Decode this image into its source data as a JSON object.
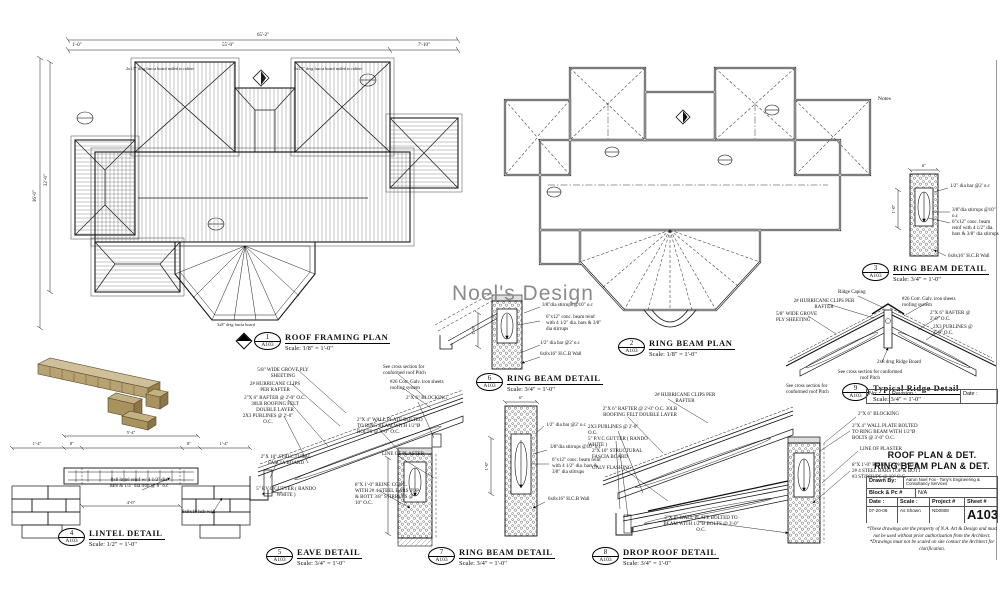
{
  "sheet": {
    "watermark": "Noel's Design",
    "notes_label": "Notes"
  },
  "plan1": {
    "num": "1",
    "ref": "A103",
    "title": "ROOF FRAMING PLAN",
    "scale": "Scale: 1/8\" = 1'-0\"",
    "dim_overall": "65'-2\"",
    "dim_main": "55'-0\"",
    "dim_right": "7'-10\"",
    "dim_end": "1'-0\"",
    "dim_v_overall": "36'-0\"",
    "dim_v_main": "32'-0\"",
    "note_fascia": "2x1.5\" drsg fascia board nailed to rafters",
    "note_bottom": "3x8\" drsg fascia board"
  },
  "plan2": {
    "num": "2",
    "ref": "A103",
    "title": "RING BEAM PLAN",
    "scale": "Scale: 1/8\" = 1'-0\""
  },
  "d3": {
    "num": "3",
    "ref": "A103",
    "title": "RING BEAM DETAIL",
    "scale": "Scale: 3/4\" = 1'-0\"",
    "bar": "1/2\" dia bar @2' o.c",
    "stirrups": "3/8\"dia stirrups @10\" o.c",
    "beam": "6\"x12\" conc. beam reinf with 4 1/2\" dia. bars & 3/8\" dia stirrups",
    "wall": "6x8x16\" H.C.B Wall",
    "dim_w": "6\"",
    "dim_h": "1'-0\""
  },
  "d4": {
    "num": "4",
    "ref": "A103",
    "title": "LINTEL DETAIL",
    "scale": "Scale: 1/2\" = 1'-0\"",
    "reinf": "8x8 lintel reinf w/ 4 1/2\" dia bars & 1/4\" dia iron @ 6\" o.c",
    "wall": "8x8x18 hcb wall",
    "dim_top": "5'-4\"",
    "dim_l": "1'-4\"",
    "dim_l8": "8\"",
    "dim_r8": "8\"",
    "dim_r": "1'-4\"",
    "dim_span": "4'-0\""
  },
  "d5": {
    "num": "5",
    "ref": "A103",
    "title": "EAVE DETAIL",
    "scale": "Scale: 3/4\" = 1'-0\"",
    "ply": "5/8\" WIDE GROVE PLY SHEETING",
    "clips": "2# HURRICANE CLIPS PER RAFTER",
    "rafter": "2\"X 6\" RAFTER @ 2'-0\" O.C. 30LB ROOFING FELT DOUBLE LAYER",
    "purlins": "2X3 PURLINES @ 2'-0\" O.C.",
    "fascia": "2\"X 10\" STRUCTURAL FASCIA BOARD",
    "gutter": "5\" P.V.C GUTTER ( RANDO WHITE )",
    "cross": "See cross section for conformed roof Pitch",
    "corr": "#26 Corr. Galv. iron sheets roofing system",
    "blocking": "2\"X 6\" BLOCKING",
    "wallplate": "2\"X 4\" WALL PLATE BOLTED TO RING BEAM WITH 1/2\"Ø BOLTS @ 3'-0\" O.C.",
    "plaster": "LINE OF PLASTER",
    "conc": "8\"X 1'-0\" REINF. CONC. WITH 2# 4 STEEL BARS TOP & BOTT 3/8\" STIRRUPS @ 10\" O.C."
  },
  "d6": {
    "num": "6",
    "ref": "A103",
    "title": "RING BEAM DETAIL",
    "scale": "Scale: 3/4\" = 1'-0\"",
    "stirrups": "3/8\"dia stirrups @10\" o.c",
    "beam": "6\"x12\" conc. beam reinf with 4 1/2\" dia. bars & 3/8\" dia stirrups",
    "bar": "1/2\" dia bar @2' o.c",
    "wall": "6x8x16\" H.C.B Wall",
    "dim_h": "1'-0\""
  },
  "d7": {
    "num": "7",
    "ref": "A103",
    "title": "RING BEAM DETAIL",
    "scale": "Scale: 3/4\" = 1'-0\"",
    "bar": "1/2\" dia bar @2' o.c",
    "stirrups": "3/8\"dia stirrups @10\" o.c",
    "beam": "6\"x12\" conc. beam reinf with 4 1/2\" dia. bars & 3/8\" dia stirrups",
    "wall": "6x8x16\" H.C.B Wall",
    "dim_h": "1'-0\"",
    "dim_w": "6\""
  },
  "d8": {
    "num": "8",
    "ref": "A103",
    "title": "DROP ROOF DETAIL",
    "scale": "Scale: 3/4\" = 1'-0\"",
    "clips": "2# HURRICANE CLIPS PER RAFTER",
    "rafter": "2\"X 6\" RAFTER @ 2'-0\" O.C. 30LB ROOFING FELT DOUBLE LAYER",
    "purlins": "2X3 PURLINES @ 2'-0\" O.C.",
    "gutter": "5\" P.V.C GUTTER ( RANDO WHITE )",
    "fascia": "2\"X 10\" STRUCTURAL FASCIA BOARD",
    "flashing": "GALV FLASHING",
    "wallplate_low": "2\"X 6\" WALL PLATE BOLTED TO BEAM WITH 1/2\"Ø BOLTS @ 3'-0\" O.C.",
    "blocking": "2\"X 6\" BLOCKING",
    "wallplate": "2\"X 4\" WALL PLATE BOLTED TO RING BEAM WITH 1/2\"Ø BOLTS @ 3'-0\" O.C.",
    "plaster": "LINE OF PLASTER",
    "conc": "8\"X 1'-0\" REINF. CONC. WITH 2# 4 STEEL BARS TOP & BOTT #3 STIRRUPS @ 10\" O.C.",
    "cross": "See cross section for conformed roof Pitch"
  },
  "d9": {
    "num": "9",
    "ref": "A103",
    "title": "Typical Ridge Detail",
    "scale": "Scale: 3/4\" = 1'-0\"",
    "capping": "Ridge Caping",
    "clips": "2# HURRICANE CLIPS PER RAFTER",
    "ply": "5/8\" WIDE GROVE PLY SHEETING",
    "corr": "#26 Corr. Galv. iron sheets roofing system",
    "rafter": "2\"X 6\" RAFTER @ 2'-0\" O.C.",
    "purlins": "2X3 PURLINES @ 2'-0\" O.C.",
    "ridge": "2x8 drsg Ridge Board",
    "cross": "See cross section for conformed roof Pitch"
  },
  "titleblock": {
    "no_label": "No:",
    "revision_label": "Revision :",
    "date_label": "Date :",
    "sheet_title1": "ROOF PLAN & DET.",
    "sheet_title2": "RING BEAM PLAN & DET.",
    "drawn_by_label": "Drawn By:",
    "drawn_by": "Aaron Noel Fox - Tony's Engineering & Consultancy Services",
    "block_label": "Block & Pc #",
    "block_value": "N/A",
    "date2_label": "Date :",
    "scale_label": "Scale :",
    "project_label": "Project #",
    "sheet_label": "Sheet #",
    "date_value": "07-20-06",
    "scale_value": "As Shown",
    "project_value": "ND0808",
    "sheet_value": "A103",
    "disclaimer": "*These drawings are the property of N.A. Art & Design and must not be used without prior authorization from the Architect. *Drawings must not be scaled on site contact the Architect for clarification."
  }
}
